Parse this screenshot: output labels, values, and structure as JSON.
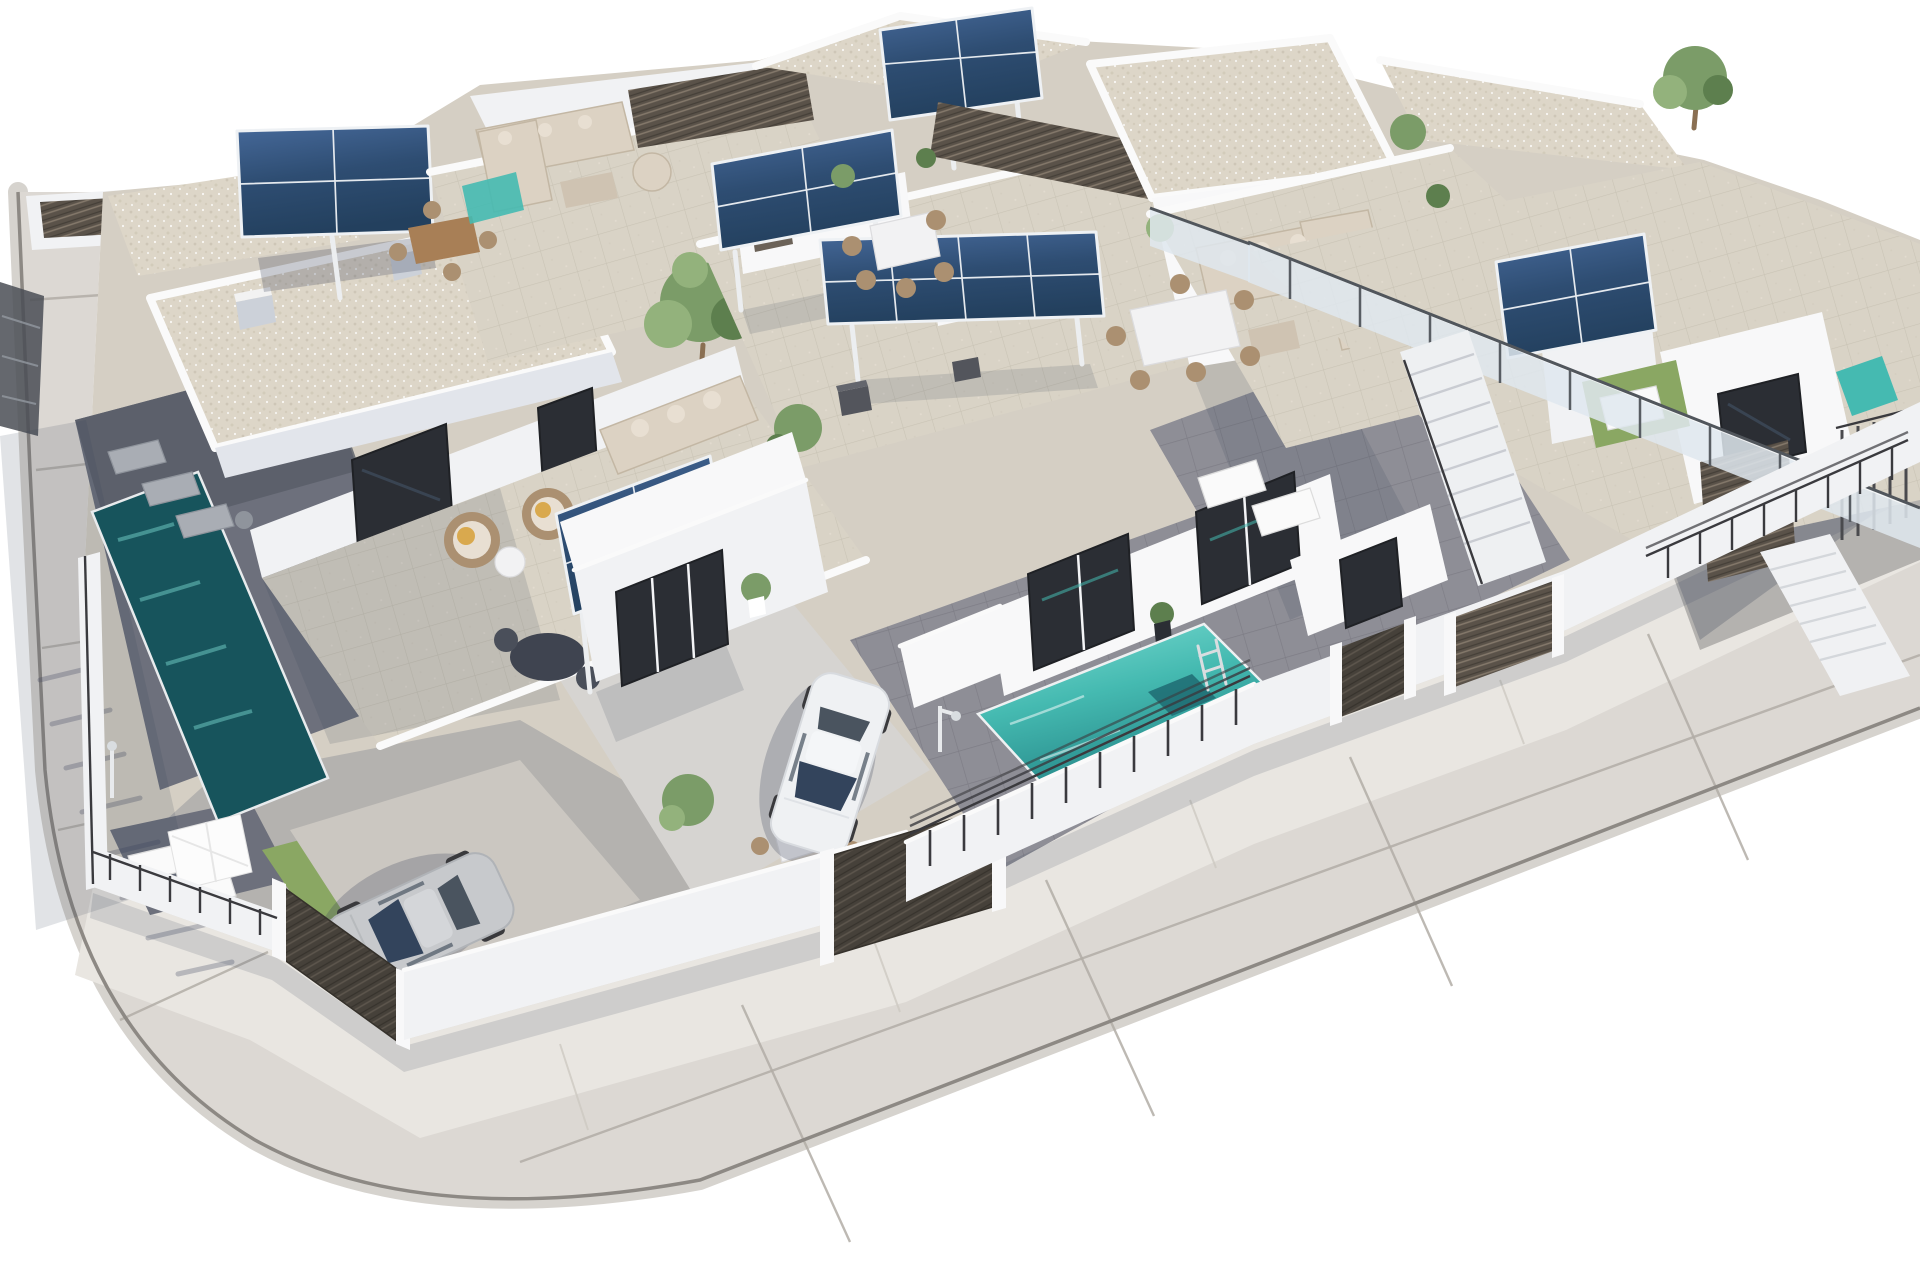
{
  "meta": {
    "type": "3d-architectural-render",
    "description": "Aerial 3D architectural rendering of a modern Mediterranean residential complex: two rows of white flat-roofed villas with gravel roofs and tiled rooftop solariums, pergolas topped with dark-blue photovoltaic solar panels over outdoor kitchens, beige corner sofas, rattan chairs with orange cushions and dining sets on the terraces, turquoise private plunge pools (one shaded on the left, one bright in the centre with a chrome ladder), a white hatchback and a silver car parked in gated driveways behind dark wooden-slat gates, black metal railings and a glass balustrade on the right, external staircases, potted plants and small lawns, all wrapped by a light-grey road with expansion-joint seams that curves around the lower-left corner of the plot on a pure white background.",
    "render_width_px": 1920,
    "render_height_px": 1280
  },
  "palette": {
    "canvas": "#ffffff",
    "road": "#dcd8d3",
    "sidewalk": "#e9e6e1",
    "road_seam": "#b2ada6",
    "sidewalk_seam": "#cdc9c2",
    "curb": "#8d8984",
    "curb_band": "#d6d3ce",
    "curb_shadow": "#5a5751",
    "plot_base": "#d5cfc4",
    "roof_gravel": "#ddd6c8",
    "roof_speckle": "#c8c0af",
    "tile_light": "#d9d3c6",
    "tile_line": "#c6bfb0",
    "patio_dark": "#8e8e96",
    "patio_line": "#7c7b84",
    "patio_mid": "#b4b2af",
    "deck_shade": "#6d707c",
    "wall_bright": "#f8f8f9",
    "wall_light": "#f1f2f4",
    "wall_shade": "#e2e5eb",
    "wall_dark": "#ccd1d9",
    "white_detail": "#fafafa",
    "post_white": "#eceef0",
    "glass_dark": "#2b2e34",
    "glass_blue": "#3d4a5a",
    "frame_dark": "#1f2125",
    "solar_deep": "#23405e",
    "solar_mid": "#2e4d72",
    "solar_light": "#46699a",
    "solar_frame": "#eef1f4",
    "pool_bright": "#45bab1",
    "pool_deep": "#1f7d80",
    "pool_shaded": "#17545c",
    "pool_streak": "#7fded4",
    "fence_slat": "#5a5249",
    "fence_slat_line": "#8a7d6f",
    "fence_dark": "#46413a",
    "fence_dark_line": "#5f584e",
    "railing": "#3a3a3e",
    "glass_panel": "#dfe8ee",
    "plant": "#7b9c68",
    "plant_light": "#93b27c",
    "plant_dark": "#5d7f4e",
    "trunk": "#8a6f52",
    "lawn": "#8aa763",
    "sofa": "#dcd2c3",
    "sofa_shadow": "#c3b7a4",
    "sofa_cushion": "#e8dfd2",
    "cushion_orange": "#d9a94e",
    "wicker": "#ab9071",
    "table_wood": "#a87f56",
    "table_white": "#f2f2f3",
    "car_white": "#eff1f3",
    "car_silver": "#c7c9cc",
    "car_glass": "#33445c",
    "car_glass_rear": "#4a545f",
    "wheel": "#3a3a3d",
    "chrome": "#d9dde0",
    "shadow_soft": "#39405a"
  },
  "scene": {
    "view": "high-angle aerial, buildings rotated diagonally, sunlight from upper right, shadows cast to lower left",
    "background": "pure white (cut-out render)",
    "inventory": {
      "villa_volumes_visible": 8,
      "rooftop_solar_arrays": 6,
      "solar_pergolas": 5,
      "swimming_pools": 4,
      "parked_cars": 2,
      "driveway_gates": 4,
      "dark_slat_privacy_screens": 5,
      "external_staircases": 2,
      "corner_sofas": 4,
      "rattan_armchairs_with_orange_cushions": 2,
      "dining_sets": 4,
      "sun_loungers": 7,
      "outdoor_kitchens_bbq": 2,
      "parasols": 1,
      "outdoor_showers": 2,
      "trees_and_potted_plants": 12,
      "glass_balustrade_runs": 2,
      "lawn_patches": 2
    },
    "road": {
      "shape": "wraps the plot along the left side and the front, rounded corner at bottom-left",
      "markings": "thin expansion-joint seams, light kerb band on outer edge"
    }
  }
}
